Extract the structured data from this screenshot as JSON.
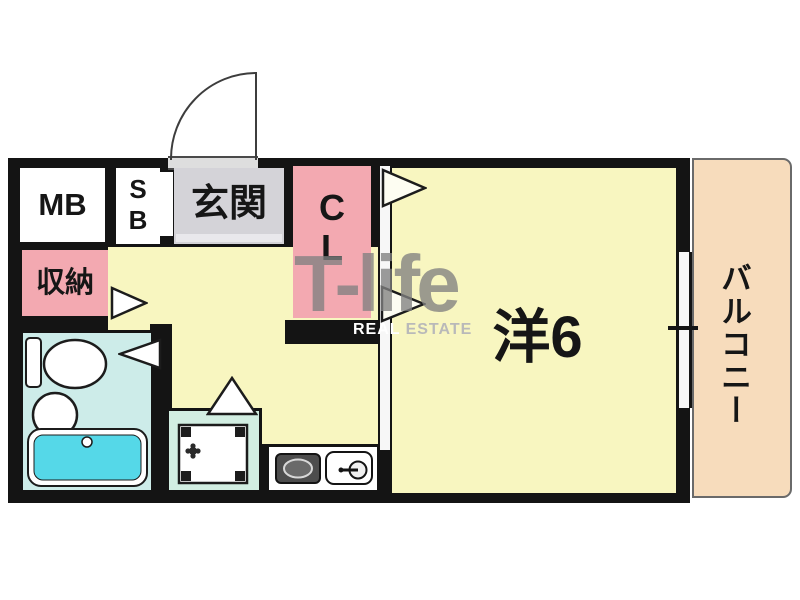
{
  "plan": {
    "labels": {
      "meter_box": "MB",
      "shoe_box_line1": "S",
      "shoe_box_line2": "B",
      "entrance": "玄関",
      "closet_line1": "C",
      "closet_line2": "L",
      "storage": "収納",
      "western_room": "洋6",
      "balcony": "バルコニー"
    },
    "watermark": {
      "brand": "T-life",
      "sub_left": "REAL",
      "sub_right": "ESTATE"
    },
    "colors": {
      "wall": "#141414",
      "room_yellow": "#F8F6C0",
      "closet_pink": "#F3A9B1",
      "entrance_gray": "#D4D3D8",
      "balcony_peach": "#F7DCBC",
      "bathroom_cyan": "#CDECE9",
      "bathtub_cyan": "#55D8E8",
      "laundry_mint": "#D2EEE2"
    }
  }
}
